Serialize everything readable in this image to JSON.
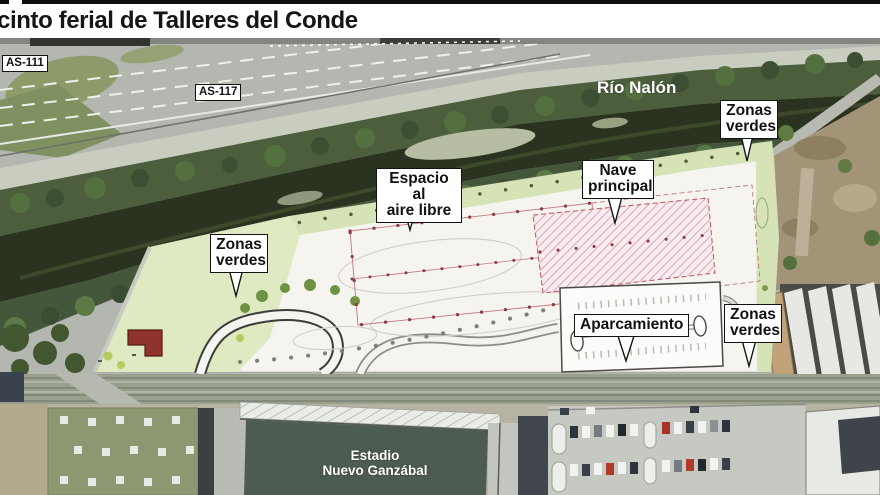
{
  "header": {
    "title": "cinto ferial de Talleres del Conde"
  },
  "map": {
    "road_labels": {
      "as111": "AS-111",
      "as117": "AS-117"
    },
    "river_label": "Río Nalón",
    "stadium_label": {
      "line1": "Estadio",
      "line2": "Nuevo Ganzábal"
    },
    "callouts": {
      "zonas_verdes_top_right": {
        "line1": "Zonas",
        "line2": "verdes"
      },
      "espacio_aire_libre": {
        "line1": "Espacio al",
        "line2": "aire libre"
      },
      "nave_principal": {
        "line1": "Nave",
        "line2": "principal"
      },
      "zonas_verdes_left": {
        "line1": "Zonas",
        "line2": "verdes"
      },
      "aparcamiento": {
        "label": "Aparcamiento"
      },
      "zonas_verdes_bottom_right": {
        "line1": "Zonas",
        "line2": "verdes"
      }
    },
    "colors": {
      "plan_green": "#d6e3b6",
      "plan_white": "#f6f4ee",
      "plan_red_outline": "#b5525c",
      "nave_hatch_red": "#c2606e",
      "river_dark": "#29331f",
      "stadium_pitch": "#4d5c50",
      "label_border": "#121212"
    }
  }
}
